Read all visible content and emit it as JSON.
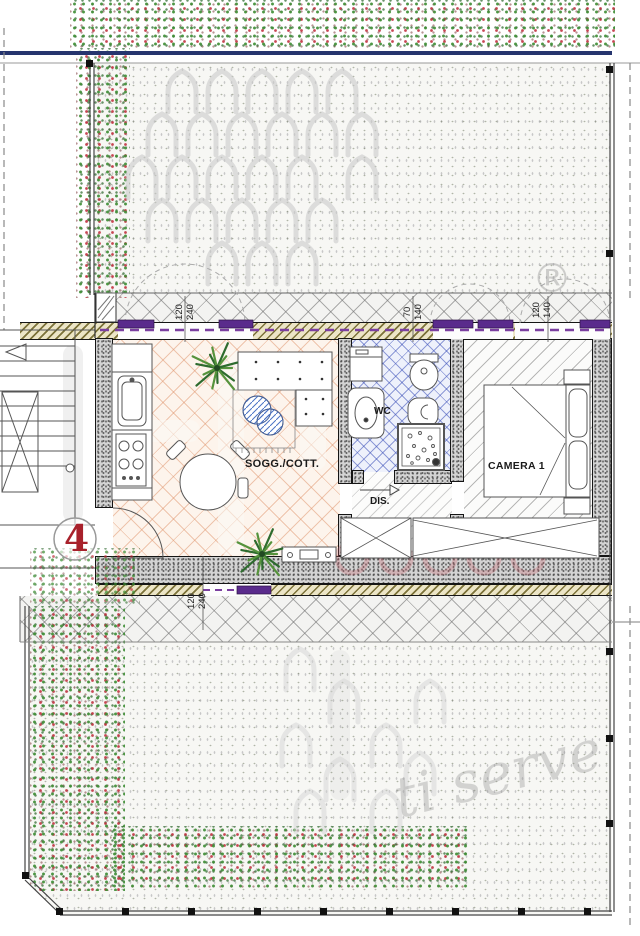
{
  "plan": {
    "unit_marker": "4",
    "rooms": {
      "living": {
        "label": "SOGG./COTT."
      },
      "bath": {
        "label": "WC"
      },
      "hall": {
        "label": "DIS."
      },
      "bedroom": {
        "label": "CAMERA  1"
      }
    },
    "window_dimensions": [
      {
        "w": "120",
        "h": "240"
      },
      {
        "w": "70",
        "h": "140"
      },
      {
        "w": "120",
        "h": "140"
      },
      {
        "w": "120",
        "h": "240"
      }
    ],
    "watermarks": {
      "registered": "®",
      "script": "ti serve"
    },
    "colors": {
      "window_purple": "#5a2b8c",
      "fence_navy": "#26356e",
      "marker_red": "#a8212b",
      "hedge_green": "#3c8c32",
      "hedge_red": "#be2832"
    },
    "decor": {
      "trees_top": [
        [
          182,
          90
        ],
        [
          222,
          90
        ],
        [
          262,
          90
        ],
        [
          302,
          90
        ],
        [
          342,
          90
        ],
        [
          162,
          133
        ],
        [
          202,
          133
        ],
        [
          242,
          133
        ],
        [
          282,
          133
        ],
        [
          322,
          133
        ],
        [
          362,
          133
        ],
        [
          142,
          176
        ],
        [
          182,
          176
        ],
        [
          222,
          176
        ],
        [
          262,
          176
        ],
        [
          302,
          176
        ],
        [
          362,
          176
        ],
        [
          162,
          219
        ],
        [
          202,
          219
        ],
        [
          242,
          219
        ],
        [
          282,
          219
        ],
        [
          322,
          219
        ],
        [
          222,
          262
        ],
        [
          262,
          262
        ],
        [
          302,
          262
        ]
      ],
      "trees_bottom": [
        [
          300,
          668
        ],
        [
          344,
          700
        ],
        [
          296,
          744
        ],
        [
          340,
          778
        ],
        [
          386,
          744
        ],
        [
          310,
          810
        ],
        [
          386,
          810
        ],
        [
          430,
          700
        ],
        [
          420,
          772
        ]
      ],
      "plants": [
        [
          217,
          368
        ],
        [
          262,
          554
        ]
      ],
      "watermark_circles": [
        [
          352,
          558
        ],
        [
          396,
          558
        ],
        [
          440,
          558
        ],
        [
          484,
          558
        ],
        [
          528,
          558
        ]
      ]
    }
  }
}
